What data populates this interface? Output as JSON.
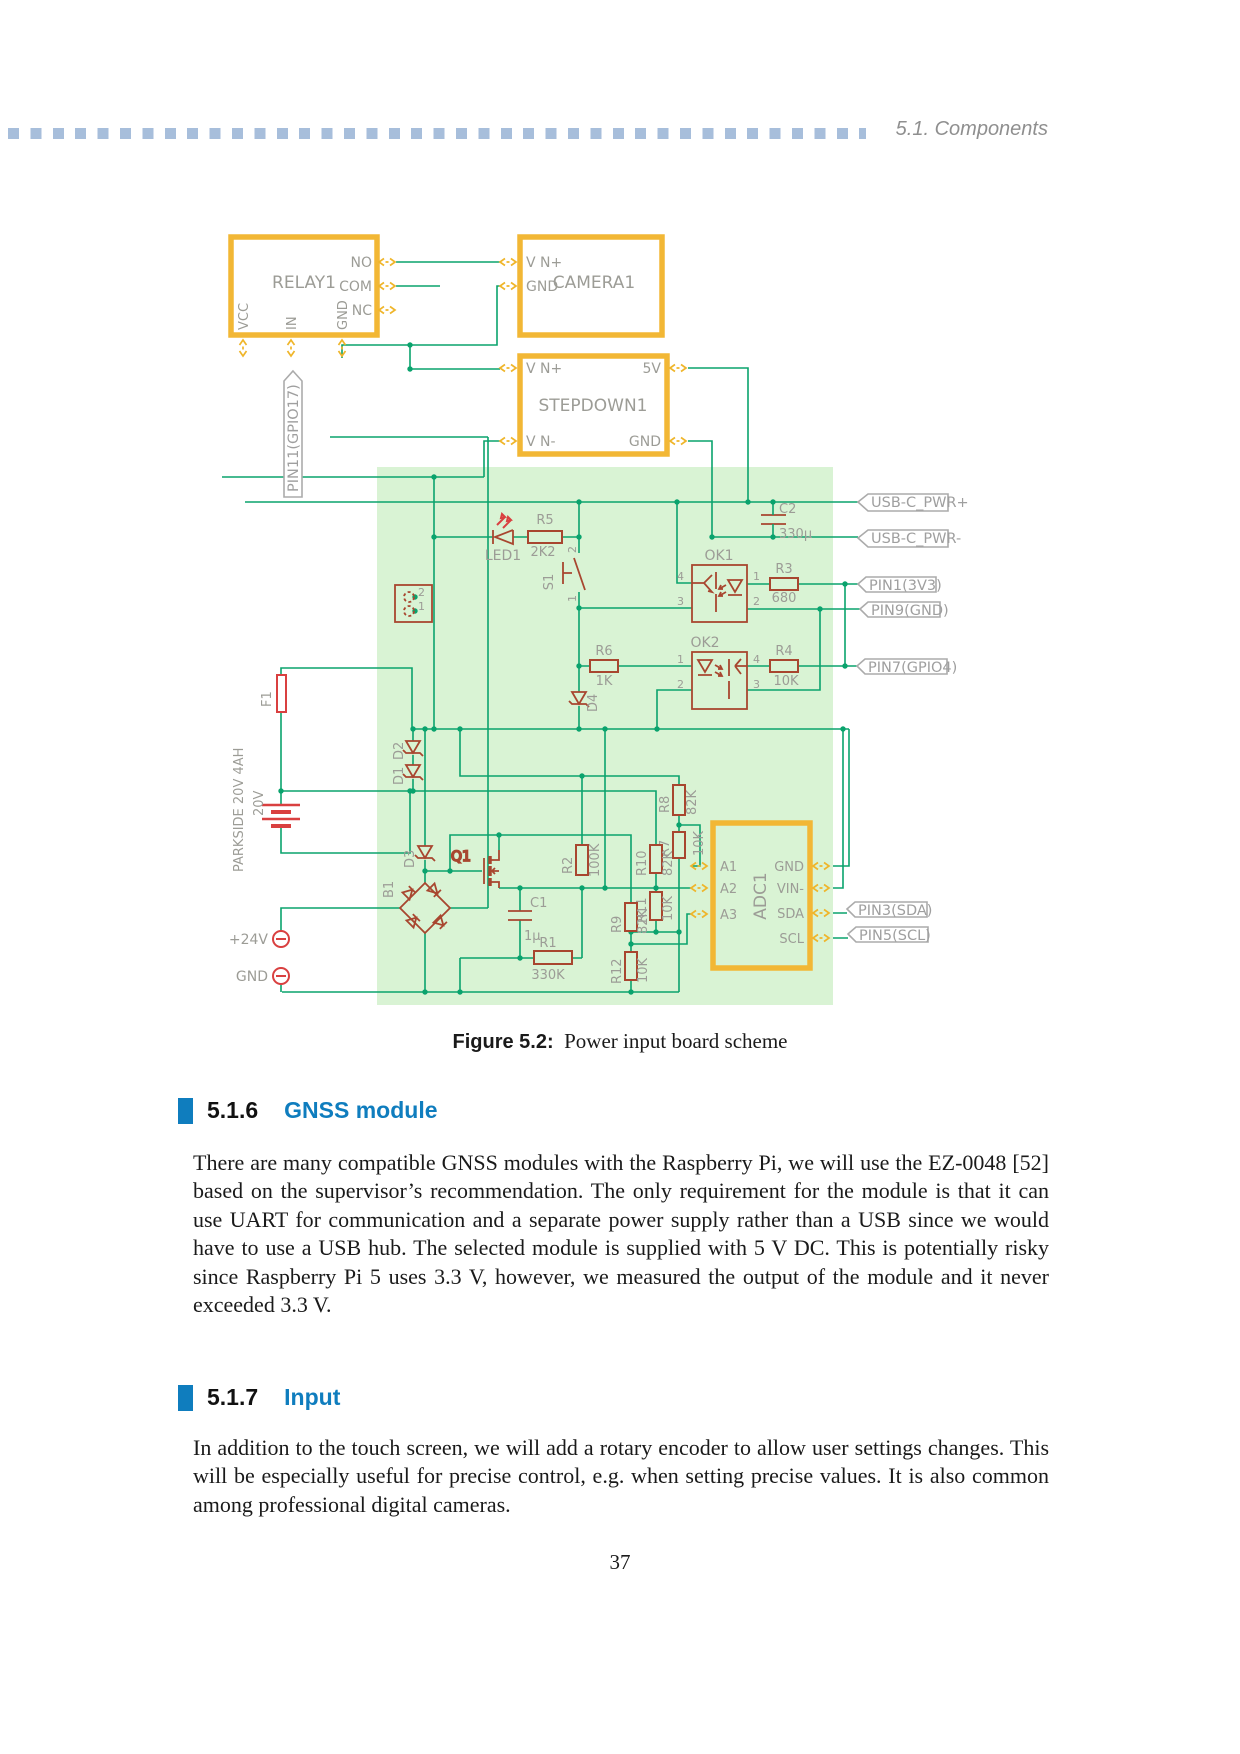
{
  "header": {
    "title": "5.1. Components"
  },
  "figure": {
    "label": "Figure 5.2:",
    "caption": "Power input board scheme"
  },
  "sections": [
    {
      "number": "5.1.6",
      "title": "GNSS module",
      "body": "There are many compatible GNSS modules with the Raspberry Pi, we will use the EZ-0048 [52] based on the supervisor’s recommendation. The only requirement for the module is that it can use UART for communication and a separate power supply rather than a USB since we would have to use a USB hub. The selected module is supplied with 5 V DC. This is potentially risky since Raspberry Pi 5 uses 3.3 V, however, we measured the output of the module and it never exceeded 3.3 V."
    },
    {
      "number": "5.1.7",
      "title": "Input",
      "body": "In addition to the touch screen, we will add a rotary encoder to allow user settings changes. This will be especially useful for precise control, e.g. when setting precise values. It is also common among professional digital cameras."
    }
  ],
  "page_number": "37",
  "colors": {
    "accent_blue": "#0f7dbe",
    "wire_green": "#0aa36d",
    "block_orange": "#f2b735",
    "component_brick": "#a8462f",
    "board_green": "#d9f3d4",
    "input_red": "#d94040",
    "header_dash_blue": "#a7bedb"
  },
  "schematic": {
    "relay": {
      "name": "RELAY1",
      "pin_no": "NO",
      "pin_com": "COM",
      "pin_nc": "NC",
      "pin_vcc": "VCC",
      "pin_in": "IN",
      "pin_gnd": "GND"
    },
    "camera": {
      "name": "CAMERA1",
      "pin_vin": "V N+",
      "pin_gnd": "GND"
    },
    "stepdown": {
      "name": "STEPDOWN1",
      "pin_vinp": "V N+",
      "pin_vinn": "V N-",
      "pin_5v": "5V",
      "pin_gnd": "GND"
    },
    "adc": {
      "name": "ADC1",
      "a1": "A1",
      "a2": "A2",
      "a3": "A3",
      "gnd": "GND",
      "vinn": "VIN-",
      "sda": "SDA",
      "scl": "SCL"
    },
    "tags": {
      "usb_plus": "USB-C_PWR+",
      "usb_minus": "USB-C_PWR-",
      "pin1": "PIN1(3V3)",
      "pin9": "PIN9(GND)",
      "pin7": "PIN7(GPIO4)",
      "pin3": "PIN3(SDA)",
      "pin5": "PIN5(SCL)",
      "pin11": "PIN11(GPIO17)"
    },
    "parts": {
      "led1": "LED1",
      "r5": "R5",
      "r5v": "2K2",
      "s1": "S1",
      "s1p1": "1",
      "s1p2": "2",
      "jp1": "1",
      "jp2": "2",
      "ok1": "OK1",
      "ok2": "OK2",
      "op1": "1",
      "op2": "2",
      "op3": "3",
      "op4": "4",
      "r3": "R3",
      "r3v": "680",
      "r4": "R4",
      "r4v": "10K",
      "r6": "R6",
      "r6v": "1K",
      "c2": "C2",
      "c2v": "330µ",
      "d4": "D4",
      "d1": "D1",
      "d2": "D2",
      "d3": "D3",
      "b1": "B1",
      "q1": "Q1",
      "f1": "F1",
      "c1": "C1",
      "c1v": "1µ",
      "r1": "R1",
      "r1v": "330K",
      "r2": "R2",
      "r2v": "100K",
      "r7": "R7",
      "r7v": "10K",
      "r8": "R8",
      "r8v": "82K",
      "r9": "R9",
      "r9v": "82K",
      "r10": "R10",
      "r10v": "82K",
      "r11": "R11",
      "r11v": "10K",
      "r12": "R12",
      "r12v": "10K",
      "battery1": "PARKSIDE 20V 4AH",
      "battery2": "20V",
      "t24": "+24V",
      "tgnd": "GND"
    }
  }
}
